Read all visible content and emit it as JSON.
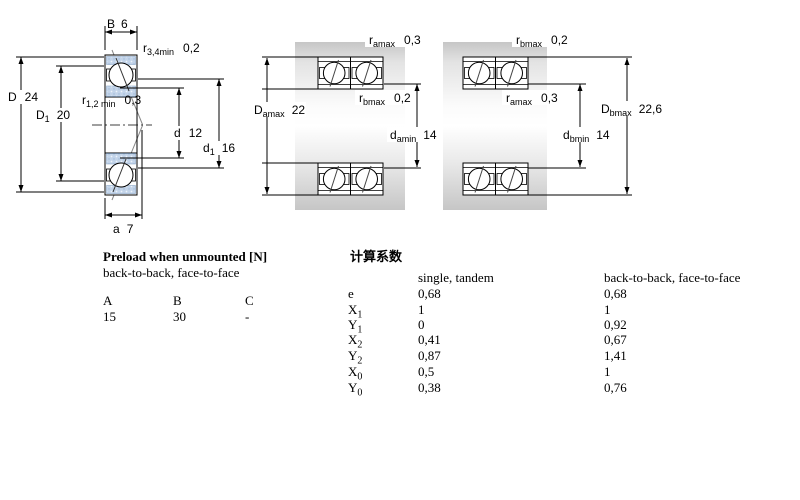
{
  "drawing": {
    "single_bearing": {
      "B": {
        "sym": "B",
        "value": "6"
      },
      "r34": {
        "sym": "r",
        "sub": "3,4min",
        "value": "0,2"
      },
      "D": {
        "sym": "D",
        "value": "24"
      },
      "D1": {
        "sym": "D",
        "sub": "1",
        "value": "20"
      },
      "r12": {
        "sym": "r",
        "sub": "1,2 min",
        "value": "0,3"
      },
      "d": {
        "sym": "d",
        "value": "12"
      },
      "d1": {
        "sym": "d",
        "sub": "1",
        "value": "16"
      },
      "a": {
        "sym": "a",
        "value": "7"
      }
    },
    "pair_a": {
      "r_top": {
        "sym": "r",
        "sub": "amax",
        "value": "0,3"
      },
      "r_mid": {
        "sym": "r",
        "sub": "bmax",
        "value": "0,2"
      },
      "D": {
        "sym": "D",
        "sub": "amax",
        "value": "22"
      },
      "d": {
        "sym": "d",
        "sub": "amin",
        "value": "14"
      }
    },
    "pair_b": {
      "r_top": {
        "sym": "r",
        "sub": "bmax",
        "value": "0,2"
      },
      "r_mid": {
        "sym": "r",
        "sub": "amax",
        "value": "0,3"
      },
      "d": {
        "sym": "d",
        "sub": "bmin",
        "value": "14"
      },
      "D": {
        "sym": "D",
        "sub": "bmax",
        "value": "22,6"
      }
    }
  },
  "preload_table": {
    "title": "Preload when unmounted [N]",
    "subtitle": "back-to-back, face-to-face",
    "columns": [
      "A",
      "B",
      "C"
    ],
    "values": [
      "15",
      "30",
      "-"
    ]
  },
  "factors_table": {
    "title": "计算系数",
    "col1_header": "single, tandem",
    "col2_header": "back-to-back, face-to-face",
    "rows": [
      {
        "sym": "e",
        "sub": "",
        "single": "0,68",
        "paired": "0,68"
      },
      {
        "sym": "X",
        "sub": "1",
        "single": "1",
        "paired": "1"
      },
      {
        "sym": "Y",
        "sub": "1",
        "single": "0",
        "paired": "0,92"
      },
      {
        "sym": "X",
        "sub": "2",
        "single": "0,41",
        "paired": "0,67"
      },
      {
        "sym": "Y",
        "sub": "2",
        "single": "0,87",
        "paired": "1,41"
      },
      {
        "sym": "X",
        "sub": "0",
        "single": "0,5",
        "paired": "1"
      },
      {
        "sym": "Y",
        "sub": "0",
        "single": "0,38",
        "paired": "0,76"
      }
    ]
  },
  "colors": {
    "ring_blue": "#c3d4e9",
    "ring_blue_dark": "#9db8d8",
    "ring_blue_light": "#eef4fb",
    "steel_gray": "#cccccc",
    "line": "#000000"
  }
}
